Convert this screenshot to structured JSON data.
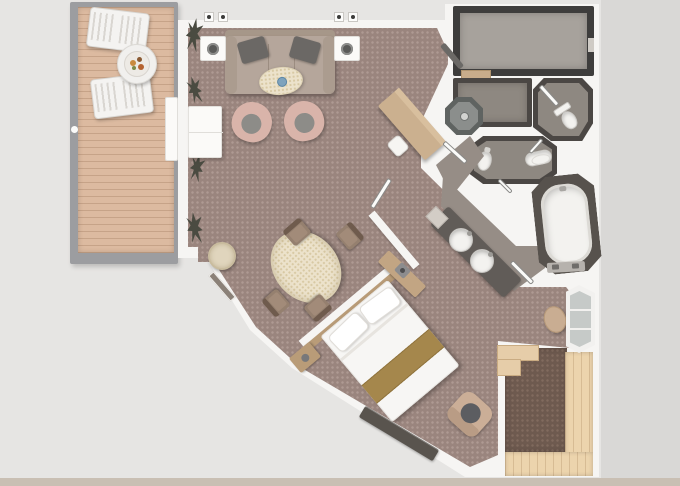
{
  "plan": {
    "type": "suite-floor-plan",
    "rooms": [
      {
        "name": "veranda"
      },
      {
        "name": "living-room"
      },
      {
        "name": "dining-area"
      },
      {
        "name": "entry-hall"
      },
      {
        "name": "walk-in-closet"
      },
      {
        "name": "dressing-room"
      },
      {
        "name": "shower"
      },
      {
        "name": "water-closet"
      },
      {
        "name": "toilet-bidet-room"
      },
      {
        "name": "bathroom"
      },
      {
        "name": "bedroom"
      },
      {
        "name": "aft-deck"
      }
    ],
    "furniture": [
      {
        "name": "sun-lounger"
      },
      {
        "name": "veranda-table"
      },
      {
        "name": "sofa"
      },
      {
        "name": "cocktail-table"
      },
      {
        "name": "armchair"
      },
      {
        "name": "sideboard"
      },
      {
        "name": "writing-desk"
      },
      {
        "name": "desk-chair"
      },
      {
        "name": "dining-table"
      },
      {
        "name": "dining-chair"
      },
      {
        "name": "side-table"
      },
      {
        "name": "double-bed"
      },
      {
        "name": "nightstand"
      },
      {
        "name": "bench"
      },
      {
        "name": "ottoman"
      },
      {
        "name": "bathtub"
      },
      {
        "name": "vanity-sink"
      },
      {
        "name": "toilet"
      },
      {
        "name": "bidet"
      },
      {
        "name": "bay-window"
      },
      {
        "name": "deck-steps"
      }
    ]
  },
  "palette": {
    "bg": "#e6e5e3",
    "bgRight": "#d9d8d6",
    "bgBottom": "#c9bfb3",
    "wall": "#f6f5f3",
    "carpet": "#9a857e",
    "carpetDot": "#ae9a93",
    "carpetDark": "#6e5a4f",
    "deck": "#dcbaa0",
    "deck2": "#ecd4ad",
    "closetWall": "#3e3d3c",
    "closetFloor": "#a7a29c",
    "roomWall": "#4b4744",
    "roomFloor": "#8e8881",
    "bathFloor": "#968d86",
    "fixture": "#f3f2ef",
    "counter": "#615c58",
    "wood": "#c2a583",
    "woodDark": "#b99c78",
    "sofa": "#b5a69b",
    "pillow": "#6b6865",
    "chairPink": "#d9b4aa",
    "cushion": "#8d8c88",
    "cream": "#ece2cb",
    "gold": "#a5874c",
    "bench": "#59544e",
    "glass": "#c6cac8",
    "plant": "#4a4b41"
  }
}
